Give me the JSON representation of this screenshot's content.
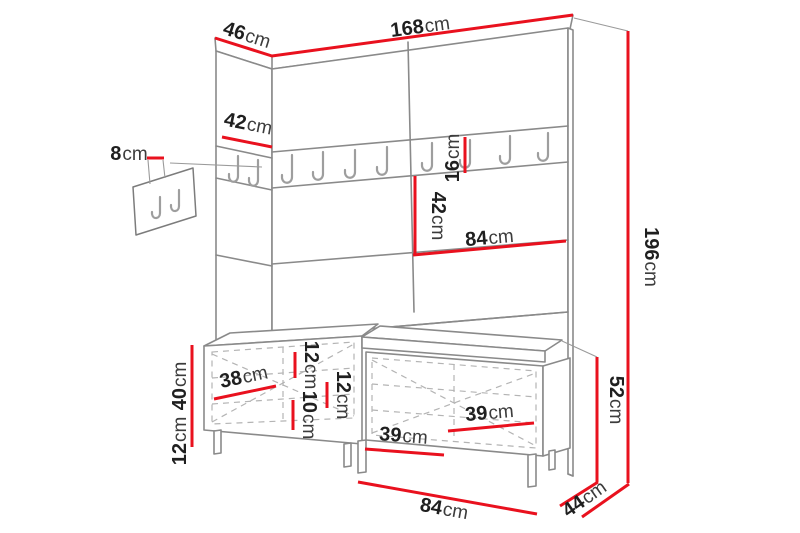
{
  "dimensions": {
    "top_width": {
      "v": "168",
      "u": "cm"
    },
    "top_depth": {
      "v": "46",
      "u": "cm"
    },
    "left_panel_width": {
      "v": "42",
      "u": "cm"
    },
    "wall_hooks_width": {
      "v": "8",
      "u": "cm"
    },
    "hook_rail_height": {
      "v": "16",
      "u": "cm"
    },
    "rail_to_shelf": {
      "v": "42",
      "u": "cm"
    },
    "panel_half_width": {
      "v": "84",
      "u": "cm"
    },
    "total_height": {
      "v": "196",
      "u": "cm"
    },
    "bench_box_height": {
      "v": "40",
      "u": "cm"
    },
    "bench_leg_height": {
      "v": "12",
      "u": "cm"
    },
    "left_door_width": {
      "v": "38",
      "u": "cm"
    },
    "seat_thickness": {
      "v": "12",
      "u": "cm"
    },
    "bottom_gap": {
      "v": "10",
      "u": "cm"
    },
    "inner_height": {
      "v": "12",
      "u": "cm"
    },
    "right_door_lower_width": {
      "v": "39",
      "u": "cm"
    },
    "right_door_upper_width": {
      "v": "39",
      "u": "cm"
    },
    "bench_total_height": {
      "v": "52",
      "u": "cm"
    },
    "bench_width": {
      "v": "84",
      "u": "cm"
    },
    "bench_depth": {
      "v": "44",
      "u": "cm"
    }
  },
  "colors": {
    "dimension_red": "#e9111e",
    "line_gray": "#8a8a8a",
    "text_dark": "#1f1f1f",
    "background": "#ffffff"
  }
}
